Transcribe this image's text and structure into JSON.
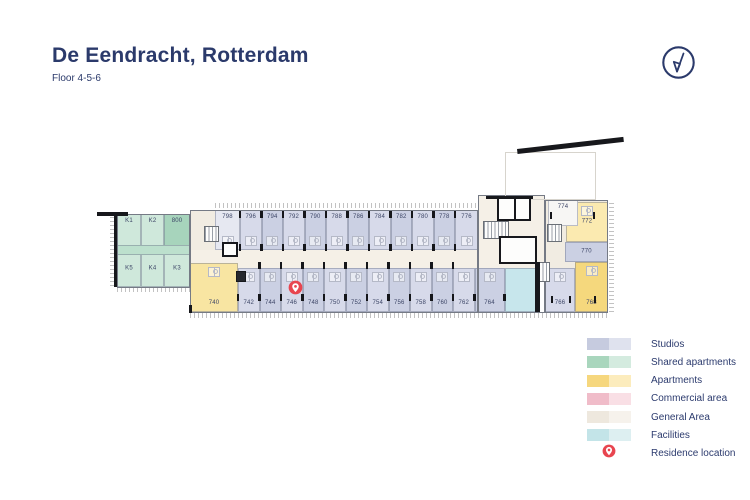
{
  "header": {
    "title": "De Eendracht, Rotterdam",
    "subtitle": "Floor 4-5-6",
    "accent": "#2b3a6b"
  },
  "legend": {
    "items": [
      {
        "label": "Studios",
        "dark": "#c6cbdf",
        "light": "#dfe2ee"
      },
      {
        "label": "Shared apartments",
        "dark": "#a9d6bd",
        "light": "#d4ebdf"
      },
      {
        "label": "Apartments",
        "dark": "#f6d77e",
        "light": "#fcecbd"
      },
      {
        "label": "Commercial area",
        "dark": "#f0bcc9",
        "light": "#f9dfe5"
      },
      {
        "label": "General Area",
        "dark": "#eee8de",
        "light": "#f6f2ec"
      },
      {
        "label": "Facilities",
        "dark": "#c3e4e8",
        "light": "#ddeff1"
      }
    ],
    "pin_label": "Residence location",
    "pin_color": "#e8454f"
  },
  "palette": {
    "studioA": "#cbd0e3",
    "studioB": "#d7daea",
    "studioPale": "#e6e8f1",
    "sharedL": "#cfe8db",
    "sharedD": "#a7d4bc",
    "sharedM": "#bce0cd",
    "yellowL": "#fbeab0",
    "yellowM": "#f8e5a2",
    "yellowD": "#f5d87d",
    "beige": "#f1ece2",
    "beigeL": "#f5f0e7",
    "cyan": "#c7e6ec",
    "whiteRoom": "#f7f6f4"
  },
  "plan": {
    "zones": [
      {
        "x": 190,
        "y": 210,
        "w": 25,
        "h": 58,
        "fill": "beige"
      },
      {
        "x": 478,
        "y": 195,
        "w": 67,
        "h": 73,
        "fill": "beigeL"
      },
      {
        "x": 545,
        "y": 200,
        "w": 63,
        "h": 68,
        "fill": "beige"
      },
      {
        "x": 190,
        "y": 250,
        "w": 355,
        "h": 18,
        "fill": "beigeL"
      }
    ],
    "rooms": [
      {
        "label": "798",
        "x": 215,
        "y": 210,
        "w": 25,
        "h": 40,
        "fill": "studioPale",
        "pos": "top",
        "pod": "s"
      },
      {
        "label": "796",
        "x": 240,
        "y": 210,
        "w": 21.5,
        "h": 40,
        "fill": "studioB",
        "pos": "top",
        "pod": "s"
      },
      {
        "label": "794",
        "x": 261.5,
        "y": 210,
        "w": 21.5,
        "h": 40,
        "fill": "studioA",
        "pos": "top",
        "pod": "s"
      },
      {
        "label": "792",
        "x": 283,
        "y": 210,
        "w": 21.5,
        "h": 40,
        "fill": "studioB",
        "pos": "top",
        "pod": "s"
      },
      {
        "label": "790",
        "x": 304.5,
        "y": 210,
        "w": 21.5,
        "h": 40,
        "fill": "studioA",
        "pos": "top",
        "pod": "s"
      },
      {
        "label": "788",
        "x": 326,
        "y": 210,
        "w": 21.5,
        "h": 40,
        "fill": "studioB",
        "pos": "top",
        "pod": "s"
      },
      {
        "label": "786",
        "x": 347.5,
        "y": 210,
        "w": 21.5,
        "h": 40,
        "fill": "studioA",
        "pos": "top",
        "pod": "s"
      },
      {
        "label": "784",
        "x": 369,
        "y": 210,
        "w": 21.5,
        "h": 40,
        "fill": "studioB",
        "pos": "top",
        "pod": "s"
      },
      {
        "label": "782",
        "x": 390.5,
        "y": 210,
        "w": 21.5,
        "h": 40,
        "fill": "studioA",
        "pos": "top",
        "pod": "s"
      },
      {
        "label": "780",
        "x": 412,
        "y": 210,
        "w": 21.5,
        "h": 40,
        "fill": "studioB",
        "pos": "top",
        "pod": "s"
      },
      {
        "label": "778",
        "x": 433.5,
        "y": 210,
        "w": 21.5,
        "h": 40,
        "fill": "studioA",
        "pos": "top",
        "pod": "s"
      },
      {
        "label": "776",
        "x": 455,
        "y": 210,
        "w": 23,
        "h": 40,
        "fill": "studioB",
        "pos": "top",
        "pod": "s"
      },
      {
        "label": "740",
        "x": 190,
        "y": 263,
        "w": 48,
        "h": 49,
        "fill": "yellowM",
        "pos": "bottom",
        "pod": "n"
      },
      {
        "label": "742",
        "x": 238,
        "y": 268,
        "w": 21.5,
        "h": 44,
        "fill": "studioB",
        "pos": "bottom",
        "pod": "n"
      },
      {
        "label": "744",
        "x": 259.5,
        "y": 268,
        "w": 21.5,
        "h": 44,
        "fill": "studioA",
        "pos": "bottom",
        "pod": "n"
      },
      {
        "label": "746",
        "x": 281,
        "y": 268,
        "w": 21.5,
        "h": 44,
        "fill": "studioB",
        "pos": "bottom",
        "pod": "n"
      },
      {
        "label": "748",
        "x": 302.5,
        "y": 268,
        "w": 21.5,
        "h": 44,
        "fill": "studioA",
        "pos": "bottom",
        "pod": "n"
      },
      {
        "label": "750",
        "x": 324,
        "y": 268,
        "w": 21.5,
        "h": 44,
        "fill": "studioB",
        "pos": "bottom",
        "pod": "n"
      },
      {
        "label": "752",
        "x": 345.5,
        "y": 268,
        "w": 21.5,
        "h": 44,
        "fill": "studioA",
        "pos": "bottom",
        "pod": "n"
      },
      {
        "label": "754",
        "x": 367,
        "y": 268,
        "w": 21.5,
        "h": 44,
        "fill": "studioB",
        "pos": "bottom",
        "pod": "n"
      },
      {
        "label": "756",
        "x": 388.5,
        "y": 268,
        "w": 21.5,
        "h": 44,
        "fill": "studioA",
        "pos": "bottom",
        "pod": "n"
      },
      {
        "label": "758",
        "x": 410,
        "y": 268,
        "w": 21.5,
        "h": 44,
        "fill": "studioB",
        "pos": "bottom",
        "pod": "n"
      },
      {
        "label": "760",
        "x": 431.5,
        "y": 268,
        "w": 21.5,
        "h": 44,
        "fill": "studioA",
        "pos": "bottom",
        "pod": "n"
      },
      {
        "label": "762",
        "x": 453,
        "y": 268,
        "w": 21.5,
        "h": 44,
        "fill": "studioB",
        "pos": "bottom",
        "pod": "n"
      },
      {
        "label": "764",
        "x": 474.5,
        "y": 268,
        "w": 30,
        "h": 44,
        "fill": "studioA",
        "pos": "bottom",
        "pod": "n"
      },
      {
        "label": null,
        "x": 504.5,
        "y": 268,
        "w": 31,
        "h": 44,
        "fill": "cyan"
      },
      {
        "label": "766",
        "x": 545,
        "y": 268,
        "w": 30,
        "h": 44,
        "fill": "studioB",
        "pos": "bottom",
        "pod": "n"
      },
      {
        "label": "768",
        "x": 575,
        "y": 262,
        "w": 33,
        "h": 50,
        "fill": "yellowD",
        "pos": "bottom",
        "pod": "n"
      },
      {
        "label": "772",
        "x": 566,
        "y": 202,
        "w": 42,
        "h": 40,
        "fill": "yellowL",
        "pos": "center",
        "pod": "n"
      },
      {
        "label": "774",
        "x": 548,
        "y": 200,
        "w": 30,
        "h": 26,
        "fill": "whiteRoom",
        "pos": "top"
      },
      {
        "label": "770",
        "x": 565,
        "y": 242,
        "w": 43,
        "h": 20,
        "fill": "studioA",
        "pos": "center"
      },
      {
        "label": "K1",
        "x": 117,
        "y": 214,
        "w": 24,
        "h": 36,
        "fill": "sharedL",
        "pos": "top"
      },
      {
        "label": "K2",
        "x": 141,
        "y": 214,
        "w": 23,
        "h": 36,
        "fill": "sharedL",
        "pos": "top"
      },
      {
        "label": "800",
        "x": 164,
        "y": 214,
        "w": 26,
        "h": 36,
        "fill": "sharedD",
        "pos": "top"
      },
      {
        "label": "K5",
        "x": 117,
        "y": 250,
        "w": 24,
        "h": 37,
        "fill": "sharedL",
        "pos": "center"
      },
      {
        "label": "K4",
        "x": 141,
        "y": 250,
        "w": 23,
        "h": 37,
        "fill": "sharedL",
        "pos": "center"
      },
      {
        "label": "K3",
        "x": 164,
        "y": 250,
        "w": 26,
        "h": 37,
        "fill": "sharedL",
        "pos": "center"
      },
      {
        "label": null,
        "x": 117,
        "y": 245,
        "w": 73,
        "h": 10,
        "fill": "sharedM"
      }
    ],
    "outlines": [
      {
        "x": 190,
        "y": 210,
        "w": 288,
        "h": 103
      },
      {
        "x": 478,
        "y": 195,
        "w": 67,
        "h": 118
      },
      {
        "x": 545,
        "y": 200,
        "w": 63,
        "h": 113
      },
      {
        "x": 117,
        "y": 214,
        "w": 73,
        "h": 74
      },
      {
        "x": 505,
        "y": 152,
        "w": 91,
        "h": 48,
        "cls": "roof"
      }
    ],
    "stairs": [
      {
        "x": 204,
        "y": 226,
        "w": 15,
        "h": 16
      },
      {
        "x": 483,
        "y": 221,
        "w": 26,
        "h": 18
      },
      {
        "x": 538,
        "y": 262,
        "w": 12,
        "h": 20
      },
      {
        "x": 547,
        "y": 224,
        "w": 15,
        "h": 18
      }
    ],
    "elevators": [
      {
        "x": 497,
        "y": 197,
        "w": 34,
        "h": 24,
        "divider": true
      },
      {
        "x": 499,
        "y": 236,
        "w": 38,
        "h": 28
      },
      {
        "x": 222,
        "y": 242,
        "w": 16,
        "h": 15
      },
      {
        "x": 236,
        "y": 271,
        "w": 10,
        "h": 11,
        "filled": true
      }
    ],
    "walls": [
      {
        "x": 97,
        "y": 212,
        "w": 31,
        "h": 4
      },
      {
        "x": 114,
        "y": 214,
        "w": 3,
        "h": 73
      },
      {
        "x": 517,
        "y": 149,
        "w": 107,
        "h": 4.5,
        "rot": -6.5
      },
      {
        "x": 535,
        "y": 262,
        "w": 5,
        "h": 50
      },
      {
        "x": 486,
        "y": 196,
        "w": 47,
        "h": 3
      },
      {
        "x": 189,
        "y": 305,
        "w": 3,
        "h": 8
      }
    ],
    "ticks": [
      {
        "x": 215,
        "y": 203,
        "w": 263,
        "h": 5,
        "dir": "v"
      },
      {
        "x": 190,
        "y": 313,
        "w": 418,
        "h": 5,
        "dir": "v"
      },
      {
        "x": 609,
        "y": 200,
        "w": 5,
        "h": 112,
        "dir": "h"
      },
      {
        "x": 110,
        "y": 216,
        "w": 4,
        "h": 70,
        "dir": "h"
      },
      {
        "x": 117,
        "y": 288,
        "w": 73,
        "h": 4,
        "dir": "v"
      }
    ],
    "doors": [
      {
        "y": 211,
        "xs": [
          240,
          261.5,
          283,
          304.5,
          326,
          347.5,
          369,
          390.5,
          412,
          433.5,
          455
        ]
      },
      {
        "y": 244,
        "xs": [
          240,
          261.5,
          283,
          304.5,
          326,
          347.5,
          369,
          390.5,
          412,
          433.5,
          455
        ]
      },
      {
        "y": 262,
        "xs": [
          259.5,
          281,
          302.5,
          324,
          345.5,
          367,
          388.5,
          410,
          431.5,
          453
        ]
      },
      {
        "y": 294,
        "xs": [
          238,
          259.5,
          281,
          302.5,
          324,
          345.5,
          367,
          388.5,
          410,
          431.5,
          453,
          474.5,
          504.5
        ]
      },
      {
        "y": 212,
        "xs": [
          551,
          594
        ]
      },
      {
        "y": 296,
        "xs": [
          552,
          570,
          595
        ]
      }
    ],
    "pin": {
      "x": 295,
      "y": 287
    }
  }
}
